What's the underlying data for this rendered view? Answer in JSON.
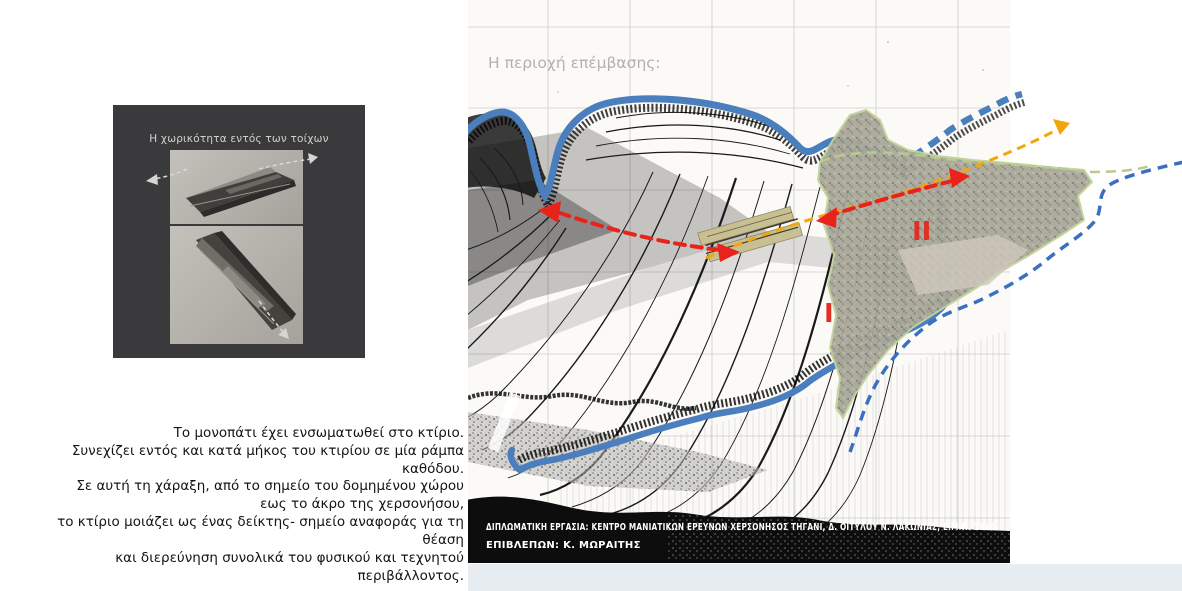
{
  "page": {
    "background": "#ffffff",
    "footer_strip_color": "#e7edf1"
  },
  "model_panel": {
    "caption": "Η χωρικότητα εντός των τοίχων",
    "background": "#3a3a3c"
  },
  "narrative": {
    "lines": [
      "Το μονοπάτι έχει ενσωματωθεί στο κτίριο.",
      "Συνεχίζει εντός και κατά μήκος του κτιρίου σε μία ράμπα καθόδου.",
      "Σε αυτή τη χάραξη, από το σημείο του δομημένου χώρου",
      "εως το άκρο της χερσονήσου,",
      "το κτίριο μοιάζει ως ένας δείκτης- σημείο αναφοράς για τη θέαση",
      "και διερεύνηση συνολικά του φυσικού και τεχνητού περιβάλλοντος."
    ]
  },
  "map": {
    "title": "Η περιοχή επέμβασης:",
    "region_labels": {
      "zone_1": "I",
      "zone_2": "II"
    },
    "credits": {
      "line1": "ΔΙΠΛΩΜΑΤΙΚΗ ΕΡΓΑΣΙΑ: ΚΕΝΤΡΟ ΜΑΝΙΑΤΙΚΩΝ ΕΡΕΥΝΩΝ ΧΕΡΣΟΝΗΣΟΣ ΤΗΓΑΝΙ, Δ. ΟΙΤΥΛΟΥ Ν. ΛΑΚΩΝΙΑΣ, Ε.Μ.Π. 1996.",
      "line2": "ΕΠΙΒΛΕΠΩΝ: Κ. ΜΩΡΑΙΤΗΣ"
    },
    "colors": {
      "coastline": "#4a7ebd",
      "sea_route_dashed": "#3b6fc0",
      "intervention_axis": "#f2a60a",
      "view_arrows": "#e8231c",
      "site_building": "#c8bf93",
      "settlement_outline": "#b6cb8c",
      "grid": "#c4c4c4",
      "paper": "#fbfaf7"
    }
  }
}
